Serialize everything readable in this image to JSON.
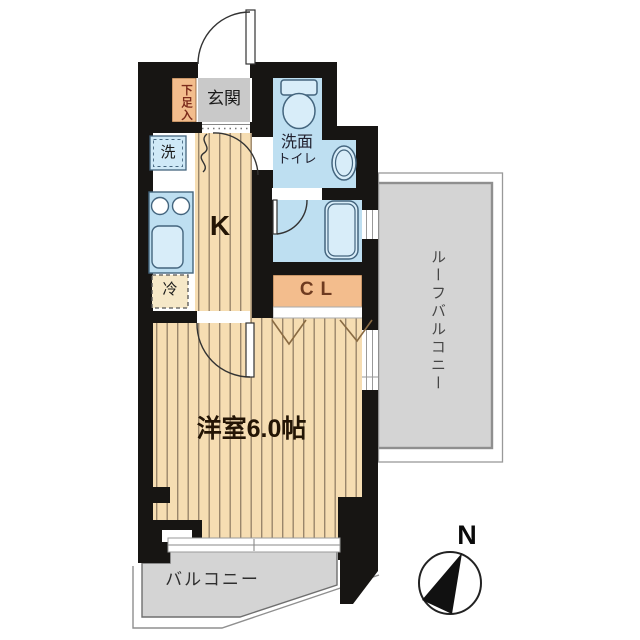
{
  "floorplan": {
    "entrance": {
      "label": "玄関"
    },
    "shoe_cabinet": {
      "label": "下足入"
    },
    "kitchen": {
      "label": "K"
    },
    "washing_machine": {
      "label": "洗"
    },
    "refrigerator": {
      "label": "冷"
    },
    "washroom_toilet": {
      "label_line1": "洗面",
      "label_line2": "トイレ"
    },
    "closet": {
      "label": "CL"
    },
    "western_room": {
      "label": "洋室6.0帖"
    },
    "balcony": {
      "label": "バルコニー"
    },
    "roof_balcony": {
      "label": "ルーフバルコニー"
    }
  },
  "compass": {
    "north_label": "N"
  },
  "colors": {
    "wall": "#171513",
    "wood-floor": "#f6ddb2",
    "wood-stripe": "#9a866b",
    "entrance-gray": "#c9c9c9",
    "closet-orange": "#f3bd8d",
    "water-blue": "#bedff1",
    "fixture-blue": "#d8edf9",
    "fixture-stroke": "#44657e",
    "balcony-gray": "#d4d4d4",
    "outline-gray": "#8f8f8f",
    "label-dark": "#241505",
    "shoe-label-red": "#7d2c1c",
    "closet-label-brown": "#6e3b20"
  }
}
